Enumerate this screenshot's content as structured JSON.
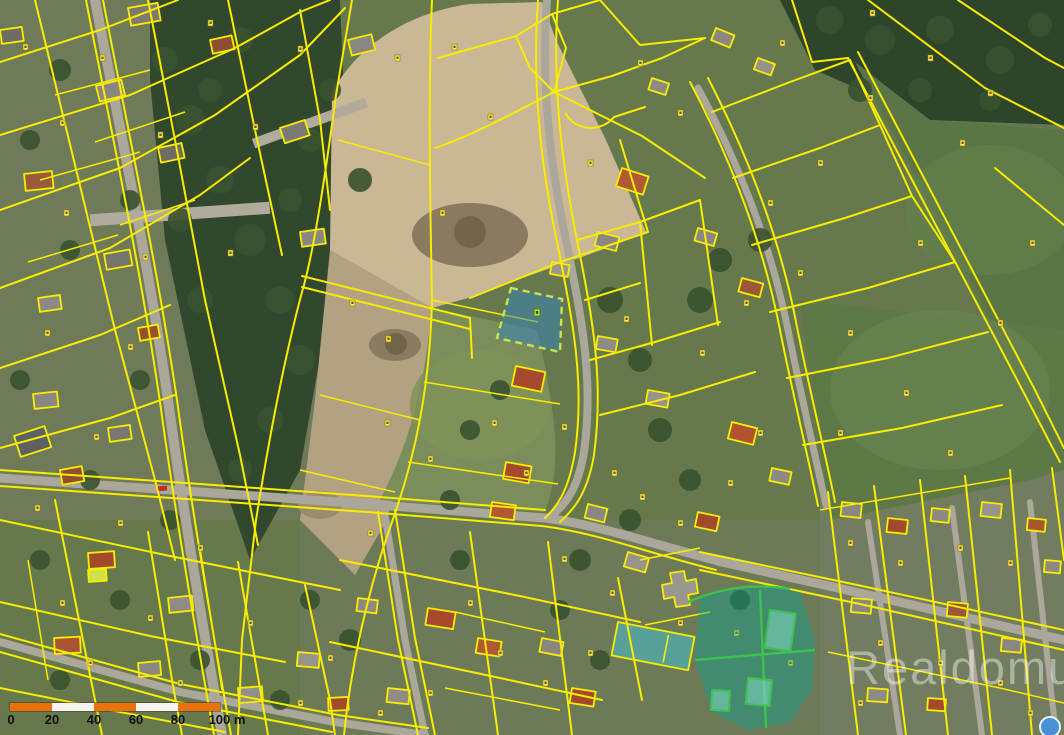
{
  "colors": {
    "parcel-line": "#f8ec00",
    "road": "#aba79b",
    "scalebar-orange": "#e9720d",
    "scalebar-white": "#f5f3ef",
    "scalebar-text": "#101010",
    "selection-fill": "rgba(52,130,188,0.52)",
    "selection-stroke": "#cbe24a",
    "green-selection-fill": "rgba(0,168,148,0.38)",
    "green-selection-stroke": "#3ec24e",
    "green-building-fill": "rgba(135,225,205,0.5)",
    "watermark-color": "rgba(255,255,255,0.42)"
  },
  "scale_bar": {
    "ticks": [
      "0",
      "20",
      "40",
      "60",
      "80",
      "100 m"
    ],
    "segment_colors": [
      "orange",
      "white",
      "orange",
      "white",
      "orange"
    ]
  },
  "watermark": {
    "text": "Realdomus"
  }
}
